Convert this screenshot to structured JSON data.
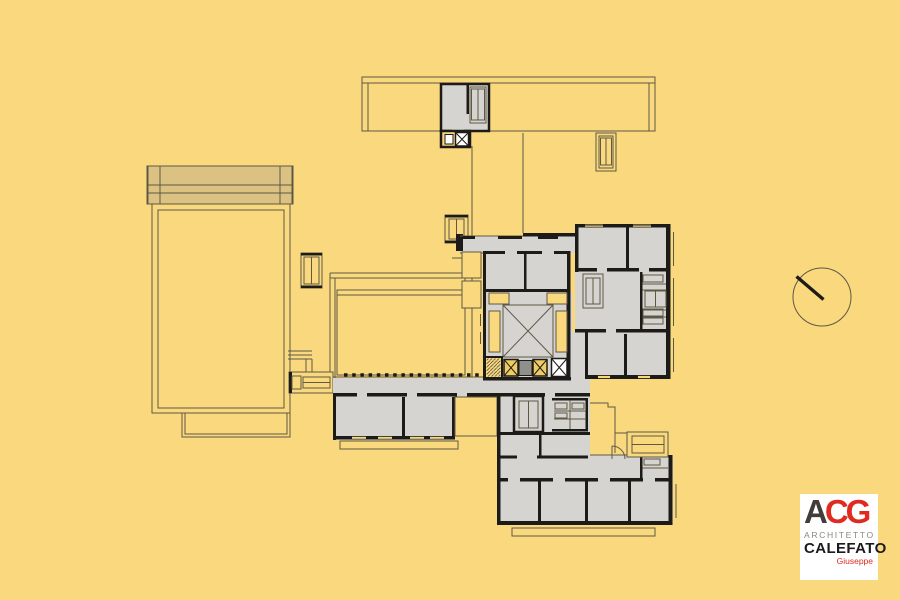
{
  "logo": {
    "acronym_a": "A",
    "acronym_cg": "CG",
    "line1": "ARCHITETTO",
    "line2": "CALEFATO",
    "line3": "Giuseppe"
  },
  "colors": {
    "background": "#F9D87E",
    "drawing_line": "#5E5844",
    "wall": "#1C1B17",
    "room_fill": "#D5D4D0",
    "band_fill": "#DBC282",
    "elevator_fill": "#EFCB62",
    "grate_fill": "#8F8F8B",
    "white": "#FFFFFF",
    "logo_red": "#E02A20",
    "logo_dark": "#403D3A",
    "logo_gray": "#8D897F",
    "logo_black": "#1B1B1B"
  }
}
